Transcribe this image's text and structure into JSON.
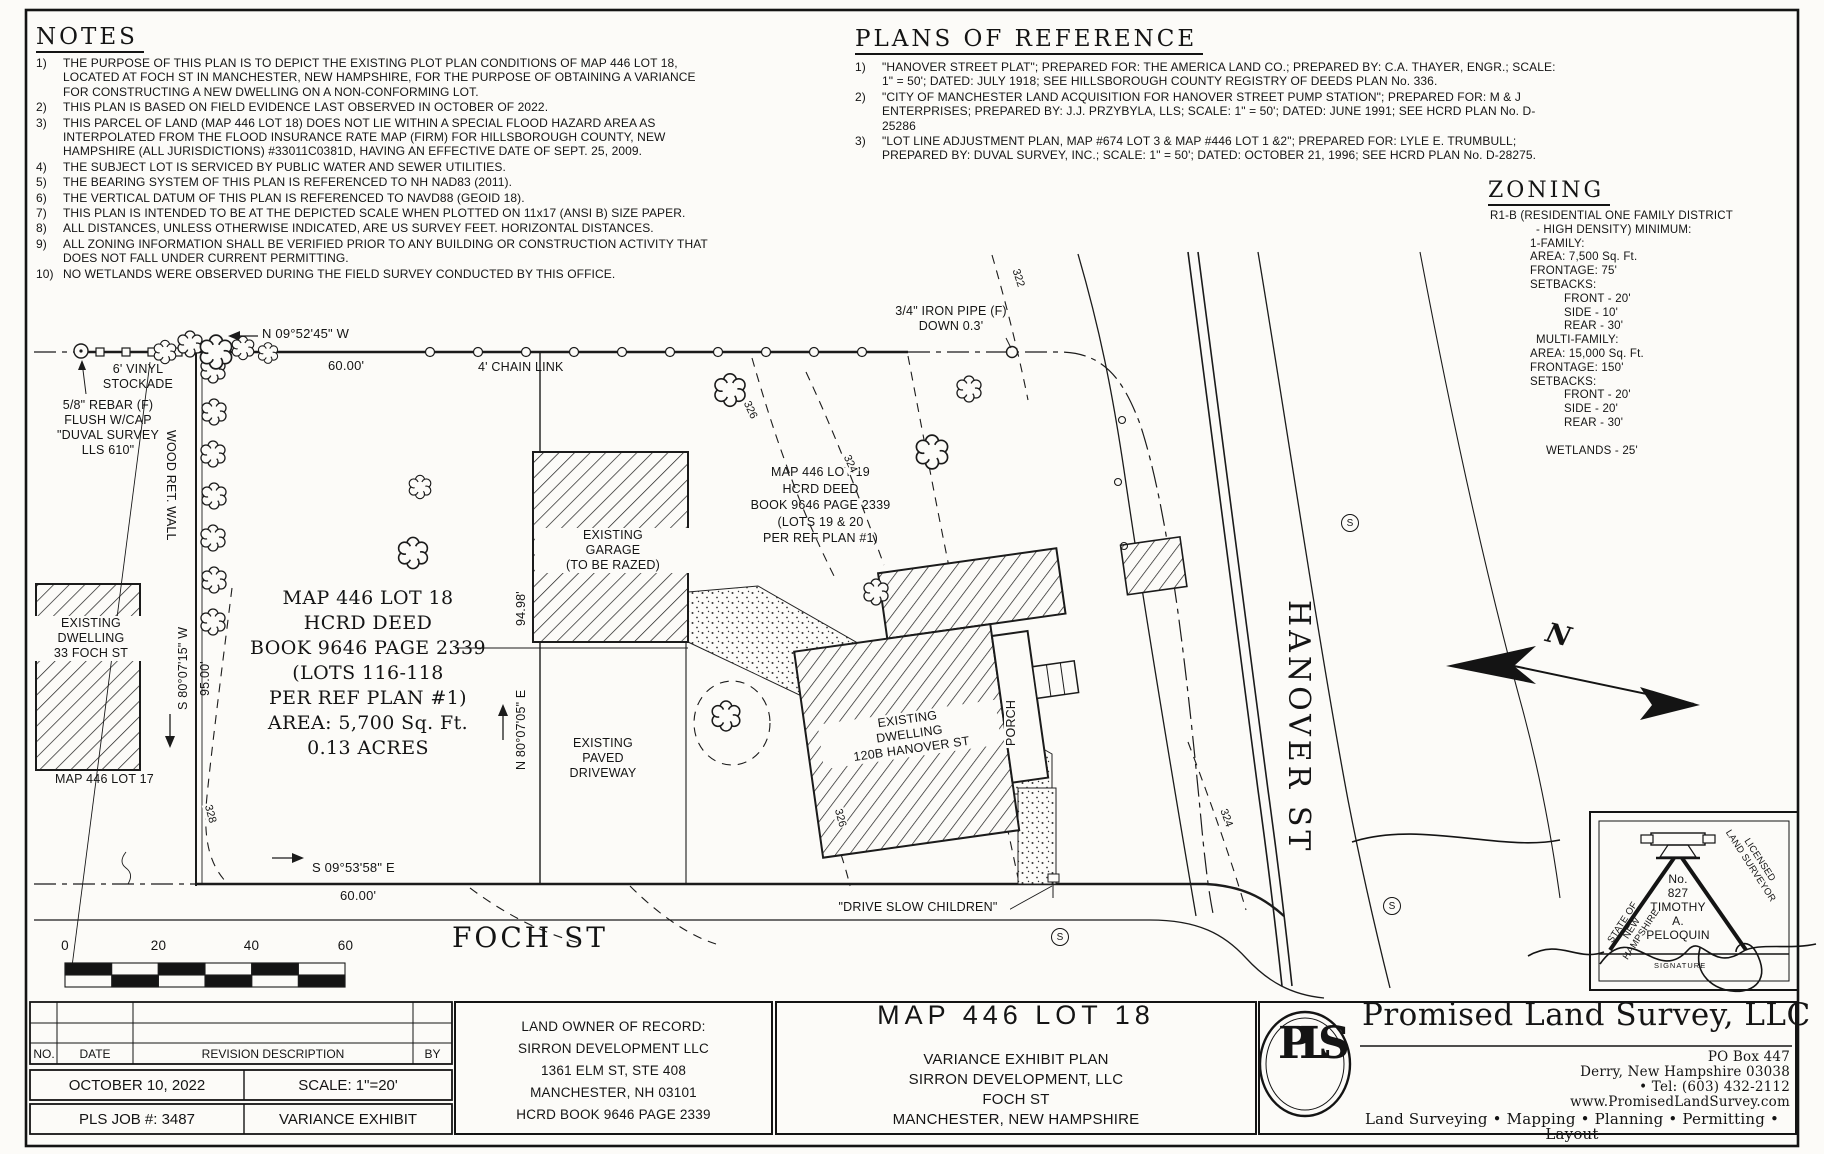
{
  "notes": {
    "heading": "NOTES",
    "items": [
      {
        "n": "1)",
        "text": "THE PURPOSE OF THIS PLAN IS TO DEPICT THE EXISTING PLOT PLAN CONDITIONS OF MAP 446 LOT 18, LOCATED AT FOCH ST IN MANCHESTER, NEW HAMPSHIRE, FOR THE PURPOSE OF OBTAINING A VARIANCE FOR CONSTRUCTING A NEW DWELLING ON A NON-CONFORMING LOT."
      },
      {
        "n": "2)",
        "text": "THIS PLAN IS BASED ON FIELD EVIDENCE LAST OBSERVED IN OCTOBER OF 2022."
      },
      {
        "n": "3)",
        "text": "THIS PARCEL OF LAND (MAP 446 LOT 18) DOES NOT LIE WITHIN A SPECIAL FLOOD HAZARD AREA AS INTERPOLATED FROM THE FLOOD INSURANCE RATE MAP (FIRM) FOR HILLSBOROUGH COUNTY, NEW HAMPSHIRE (ALL JURISDICTIONS) #33011C0381D, HAVING AN EFFECTIVE DATE OF SEPT. 25, 2009."
      },
      {
        "n": "4)",
        "text": "THE SUBJECT LOT IS SERVICED BY PUBLIC WATER AND SEWER UTILITIES."
      },
      {
        "n": "5)",
        "text": "THE BEARING SYSTEM OF THIS PLAN IS REFERENCED TO NH NAD83 (2011)."
      },
      {
        "n": "6)",
        "text": "THE VERTICAL DATUM OF THIS PLAN IS REFERENCED TO NAVD88 (GEOID 18)."
      },
      {
        "n": "7)",
        "text": "THIS PLAN IS INTENDED TO BE AT THE DEPICTED SCALE WHEN PLOTTED ON 11x17 (ANSI B) SIZE PAPER."
      },
      {
        "n": "8)",
        "text": "ALL DISTANCES, UNLESS OTHERWISE INDICATED, ARE US SURVEY FEET. HORIZONTAL DISTANCES."
      },
      {
        "n": "9)",
        "text": "ALL ZONING INFORMATION SHALL BE VERIFIED PRIOR TO ANY BUILDING OR CONSTRUCTION ACTIVITY THAT DOES NOT FALL UNDER CURRENT PERMITTING."
      },
      {
        "n": "10)",
        "text": "NO WETLANDS WERE OBSERVED DURING THE FIELD SURVEY CONDUCTED BY THIS OFFICE."
      }
    ]
  },
  "plans_of_reference": {
    "heading": "PLANS OF REFERENCE",
    "items": [
      {
        "n": "1)",
        "text": "\"HANOVER STREET PLAT\"; PREPARED FOR: THE AMERICA LAND CO.; PREPARED BY: C.A. THAYER, ENGR.; SCALE: 1\" = 50'; DATED: JULY 1918; SEE HILLSBOROUGH COUNTY REGISTRY OF DEEDS PLAN No. 336."
      },
      {
        "n": "2)",
        "text": "\"CITY OF MANCHESTER LAND ACQUISITION FOR HANOVER STREET PUMP STATION\"; PREPARED FOR: M & J ENTERPRISES; PREPARED BY: J.J. PRZYBYLA, LLS; SCALE: 1\" = 50'; DATED: JUNE 1991; SEE HCRD PLAN No. D-25286"
      },
      {
        "n": "3)",
        "text": "\"LOT LINE ADJUSTMENT PLAN, MAP #674 LOT 3 & MAP #446 LOT 1 &2\"; PREPARED FOR: LYLE E. TRUMBULL; PREPARED BY: DUVAL SURVEY, INC.; SCALE: 1\" = 50'; DATED: OCTOBER 21, 1996; SEE HCRD PLAN No. D-28275."
      }
    ]
  },
  "zoning": {
    "heading": "ZONING",
    "lines": [
      "R1-B (RESIDENTIAL ONE FAMILY DISTRICT",
      "- HIGH DENSITY) MINIMUM:",
      "1-FAMILY:",
      "AREA: 7,500 Sq. Ft.",
      "FRONTAGE: 75'",
      "SETBACKS:",
      "FRONT - 20'",
      "SIDE - 10'",
      "REAR - 30'",
      "MULTI-FAMILY:",
      "AREA: 15,000 Sq. Ft.",
      "FRONTAGE: 150'",
      "SETBACKS:",
      "FRONT - 20'",
      "SIDE - 20'",
      "REAR - 30'",
      "WETLANDS - 25'"
    ]
  },
  "plan": {
    "bearing_top": "N 09°52'45\" W",
    "dist_top": "60.00'",
    "bearing_left": "S 80°07'15\" W",
    "dist_left": "95.00'",
    "bearing_right": "N 80°07'05\" E",
    "dist_right": "94.98'",
    "bearing_bottom": "S 09°53'58\" E",
    "dist_bottom": "60.00'",
    "vinyl_stockade": "6' VINYL\nSTOCKADE",
    "chain_link": "4' CHAIN LINK",
    "rebar": "5/8\" REBAR (F)\nFLUSH W/CAP\n\"DUVAL SURVEY\nLLS 610\"",
    "iron_pipe": "3/4\" IRON PIPE (F)\nDOWN 0.3'",
    "wood_wall": "WOOD RET. WALL",
    "lot18": "MAP 446 LOT 18\nHCRD DEED\nBOOK 9646 PAGE 2339\n(LOTS 116-118\nPER REF PLAN #1)\nAREA: 5,700 Sq. Ft.\n0.13 ACRES",
    "lot19": "MAP 446 LOT 19\nHCRD DEED\nBOOK 9646 PAGE 2339\n(LOTS 19 & 20\nPER REF PLAN #1)",
    "lot17": "MAP 446 LOT 17",
    "dwelling33": "EXISTING\nDWELLING\n33 FOCH ST",
    "garage": "EXISTING\nGARAGE\n(TO BE RAZED)",
    "driveway": "EXISTING\nPAVED\nDRIVEWAY",
    "dwelling120": "EXISTING\nDWELLING\n120B HANOVER ST",
    "porch": "PORCH",
    "foch_st": "FOCH ST",
    "hanover_st": "HANOVER ST",
    "drive_slow": "\"DRIVE SLOW CHILDREN\"",
    "north": "N",
    "sewer": "S",
    "contours": {
      "c322": "322",
      "c324": "324",
      "c326": "326",
      "c328": "328"
    },
    "scale_ticks": [
      "0",
      "20",
      "40",
      "60"
    ]
  },
  "title_block": {
    "revision": {
      "no": "NO.",
      "date": "DATE",
      "description": "REVISION DESCRIPTION",
      "by": "BY"
    },
    "date": "OCTOBER 10, 2022",
    "scale": "SCALE: 1\"=20'",
    "job": "PLS JOB #: 3487",
    "type": "VARIANCE EXHIBIT",
    "owner": "LAND OWNER OF RECORD:\nSIRRON DEVELOPMENT LLC\n1361 ELM ST, STE 408\nMANCHESTER, NH 03101\nHCRD BOOK 9646 PAGE 2339",
    "plan_title": "MAP 446 LOT 18",
    "plan_subtitle": "VARIANCE EXHIBIT PLAN\nSIRRON DEVELOPMENT, LLC\nFOCH ST\nMANCHESTER, NEW HAMPSHIRE",
    "firm": {
      "logo": "PLS",
      "name": "Promised Land Survey, LLC",
      "address": "PO Box 447\nDerry, New Hampshire 03038\n• Tel: (603) 432-2112\nwww.PromisedLandSurvey.com",
      "services": "Land Surveying • Mapping • Planning • Permitting • Layout"
    }
  },
  "stamp": {
    "state": "STATE OF\nNEW HAMPSHIRE",
    "licensed": "LICENSED\nLAND SURVEYOR",
    "center": "No.\n827\nTIMOTHY\nA.\nPELOQUIN",
    "signature": "SIGNATURE"
  }
}
